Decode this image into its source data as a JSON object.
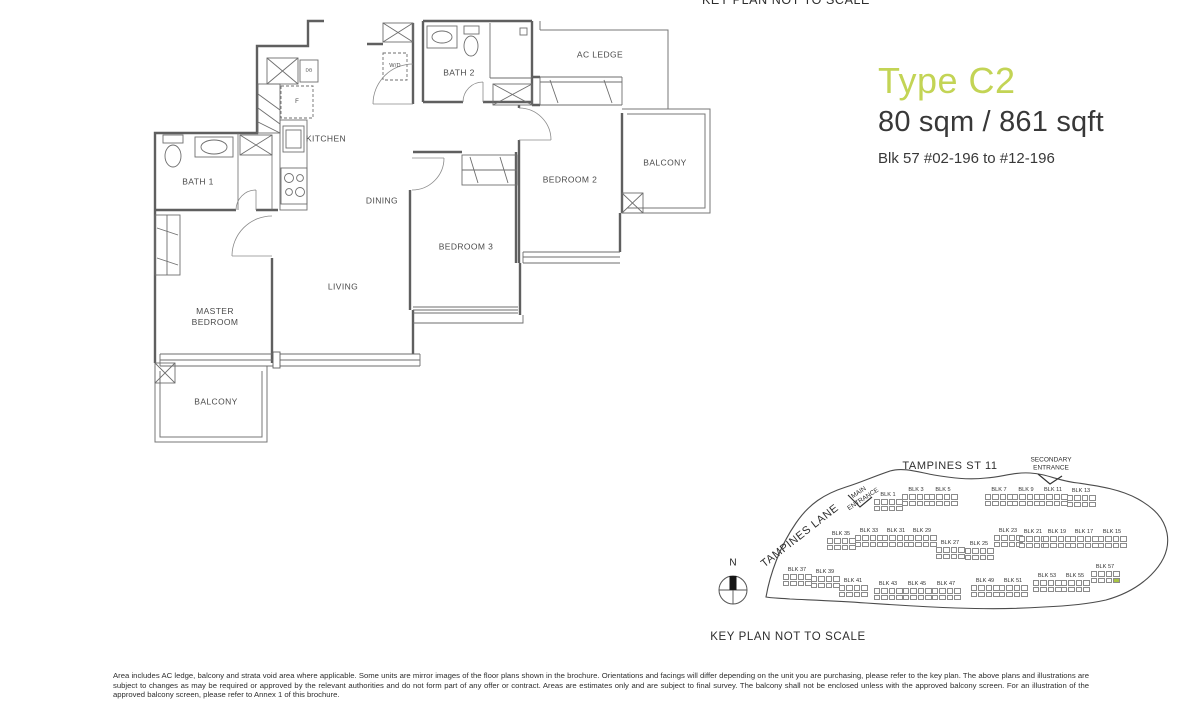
{
  "page": {
    "top_caption": "KEY PLAN NOT TO SCALE",
    "disclaimer": "Area includes AC ledge, balcony and strata void area where applicable. Some units are mirror images of the floor plans shown in the brochure. Orientations and facings will differ depending on the unit you are purchasing, please refer to the key plan. The above plans and illustrations are subject to changes as may be required or approved by the relevant authorities and do not form part of any offer or contract. Areas are estimates only and are subject to final survey. The balcony shall not be enclosed unless with the approved balcony screen. For an illustration of the approved balcony screen, please refer to Annex 1 of this brochure."
  },
  "title_block": {
    "type_label": "Type C2",
    "area": "80 sqm / 861 sqft",
    "unit_range": "Blk 57  #02-196 to #12-196",
    "accent_color": "#c3d455"
  },
  "floorplan": {
    "labels": {
      "kitchen": "KITCHEN",
      "dining": "DINING",
      "living": "LIVING",
      "master_bedroom": "MASTER\nBEDROOM",
      "bedroom_2": "BEDROOM 2",
      "bedroom_3": "BEDROOM 3",
      "bath_1": "BATH 1",
      "bath_2": "BATH 2",
      "balcony_lower": "BALCONY",
      "balcony_right": "BALCONY",
      "ac_ledge": "AC LEDGE",
      "washer_dryer": "W/D",
      "fridge": "F",
      "db": "DB"
    }
  },
  "keyplan": {
    "caption": "KEY PLAN NOT TO SCALE",
    "street": "TAMPINES ST 11",
    "lane": "TAMPINES LANE",
    "main_entrance": "MAIN\nENTRANCE",
    "secondary_entrance": "SECONDARY\nENTRANCE",
    "compass": "N",
    "highlight_color": "#a9c443",
    "highlight_block": "BLK 57",
    "blocks": [
      {
        "label": "BLK 1",
        "x": 888,
        "y": 496
      },
      {
        "label": "BLK 3",
        "x": 916,
        "y": 491
      },
      {
        "label": "BLK 5",
        "x": 943,
        "y": 491
      },
      {
        "label": "BLK 7",
        "x": 999,
        "y": 491
      },
      {
        "label": "BLK 9",
        "x": 1026,
        "y": 491
      },
      {
        "label": "BLK 11",
        "x": 1053,
        "y": 491
      },
      {
        "label": "BLK 13",
        "x": 1081,
        "y": 492
      },
      {
        "label": "BLK 35",
        "x": 841,
        "y": 535
      },
      {
        "label": "BLK 33",
        "x": 869,
        "y": 532
      },
      {
        "label": "BLK 31",
        "x": 896,
        "y": 532
      },
      {
        "label": "BLK 29",
        "x": 922,
        "y": 532
      },
      {
        "label": "BLK 27",
        "x": 950,
        "y": 544
      },
      {
        "label": "BLK 25",
        "x": 979,
        "y": 545
      },
      {
        "label": "BLK 23",
        "x": 1008,
        "y": 532
      },
      {
        "label": "BLK 21",
        "x": 1033,
        "y": 533
      },
      {
        "label": "BLK 19",
        "x": 1057,
        "y": 533
      },
      {
        "label": "BLK 17",
        "x": 1084,
        "y": 533
      },
      {
        "label": "BLK 15",
        "x": 1112,
        "y": 533
      },
      {
        "label": "BLK 37",
        "x": 797,
        "y": 571
      },
      {
        "label": "BLK 39",
        "x": 825,
        "y": 573
      },
      {
        "label": "BLK 41",
        "x": 853,
        "y": 582
      },
      {
        "label": "BLK 43",
        "x": 888,
        "y": 585
      },
      {
        "label": "BLK 45",
        "x": 917,
        "y": 585
      },
      {
        "label": "BLK 47",
        "x": 946,
        "y": 585
      },
      {
        "label": "BLK 49",
        "x": 985,
        "y": 582
      },
      {
        "label": "BLK 51",
        "x": 1013,
        "y": 582
      },
      {
        "label": "BLK 53",
        "x": 1047,
        "y": 577
      },
      {
        "label": "BLK 55",
        "x": 1075,
        "y": 577
      },
      {
        "label": "BLK 57",
        "x": 1105,
        "y": 568,
        "highlight": true
      }
    ]
  }
}
